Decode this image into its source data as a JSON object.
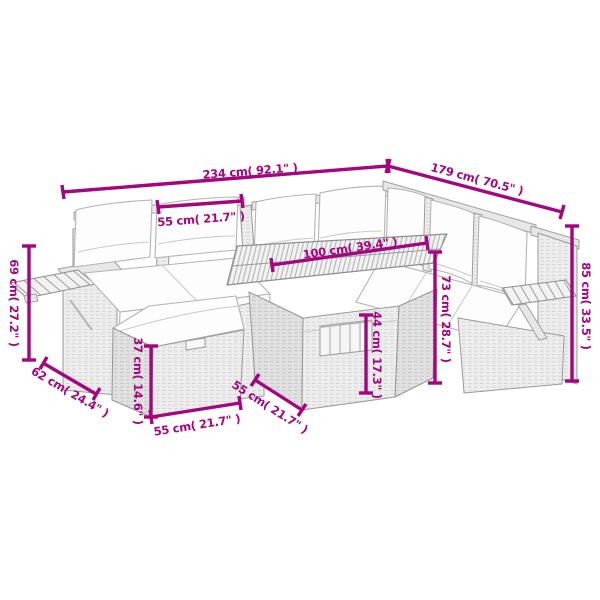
{
  "meta": {
    "background_color": "#ffffff",
    "accent_color": "#a3067e",
    "furniture_fill": "#ececec",
    "furniture_outline": "#9a9a9a",
    "cushion_fill": "#fdfdfd"
  },
  "diagram": {
    "subject": "garden-sofa-set-with-table-and-ottoman",
    "dimensions": [
      {
        "id": "total-width",
        "label": "234 cm( 92.1\" )"
      },
      {
        "id": "total-depth",
        "label": "179 cm( 70.5\" )"
      },
      {
        "id": "seat-section-width",
        "label": "55 cm( 21.7\" )"
      },
      {
        "id": "table-length",
        "label": "100 cm( 39.4\" )"
      },
      {
        "id": "armrest-height",
        "label": "69 cm( 27.2\" )"
      },
      {
        "id": "sofa-depth",
        "label": "62 cm( 24.4\" )"
      },
      {
        "id": "ottoman-height",
        "label": "37 cm( 14.6\" )"
      },
      {
        "id": "ottoman-width",
        "label": "55 cm( 21.7\" )"
      },
      {
        "id": "table-depth",
        "label": "55 cm( 21.7\" )"
      },
      {
        "id": "table-clearance-height",
        "label": "44 cm( 17.3\" )"
      },
      {
        "id": "table-height",
        "label": "73 cm( 28.7\" )"
      },
      {
        "id": "backrest-height",
        "label": "85 cm( 33.5\" )"
      }
    ]
  }
}
